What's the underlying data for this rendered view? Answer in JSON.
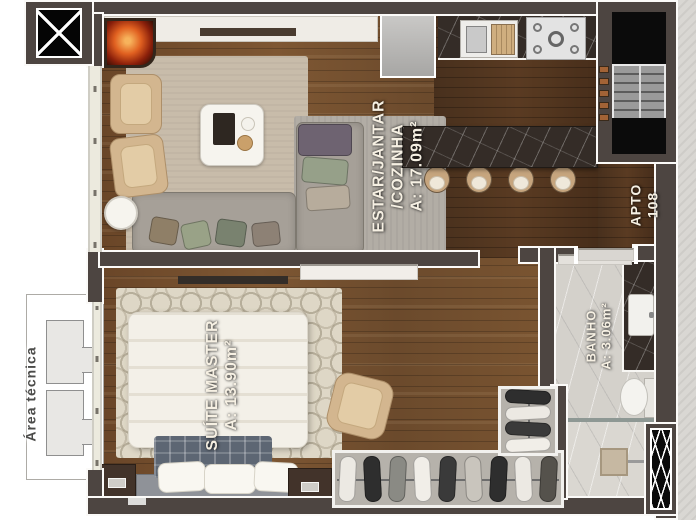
{
  "labels": {
    "living": {
      "line1": "ESTAR/JANTAR",
      "line2": "/COZINHA",
      "area": "A: 17.09m²"
    },
    "suite": {
      "name": "SUÍTE MASTER",
      "area": "A: 13.90m²"
    },
    "bath": {
      "name": "BANHO",
      "area": "A: 3.06m²"
    },
    "apartment": {
      "line1": "APTO",
      "line2": "108"
    },
    "technical": {
      "name": "Área técnica"
    }
  },
  "colors": {
    "wall": "#4d4541",
    "wood_floor": "#6f4b2b",
    "wood_floor_dark": "#4c311d",
    "island_marble": "#342c27",
    "living_rug": "#c8bcaa",
    "bedroom_rug": "#ded7c6",
    "sofa": "#a6a098",
    "bed_linen": "#f3f0e8",
    "bath_floor": "#d4d1cb",
    "exterior_concrete": "#d9d7d3",
    "fire": "#c2491c",
    "label_text": "#f6f0e3"
  }
}
